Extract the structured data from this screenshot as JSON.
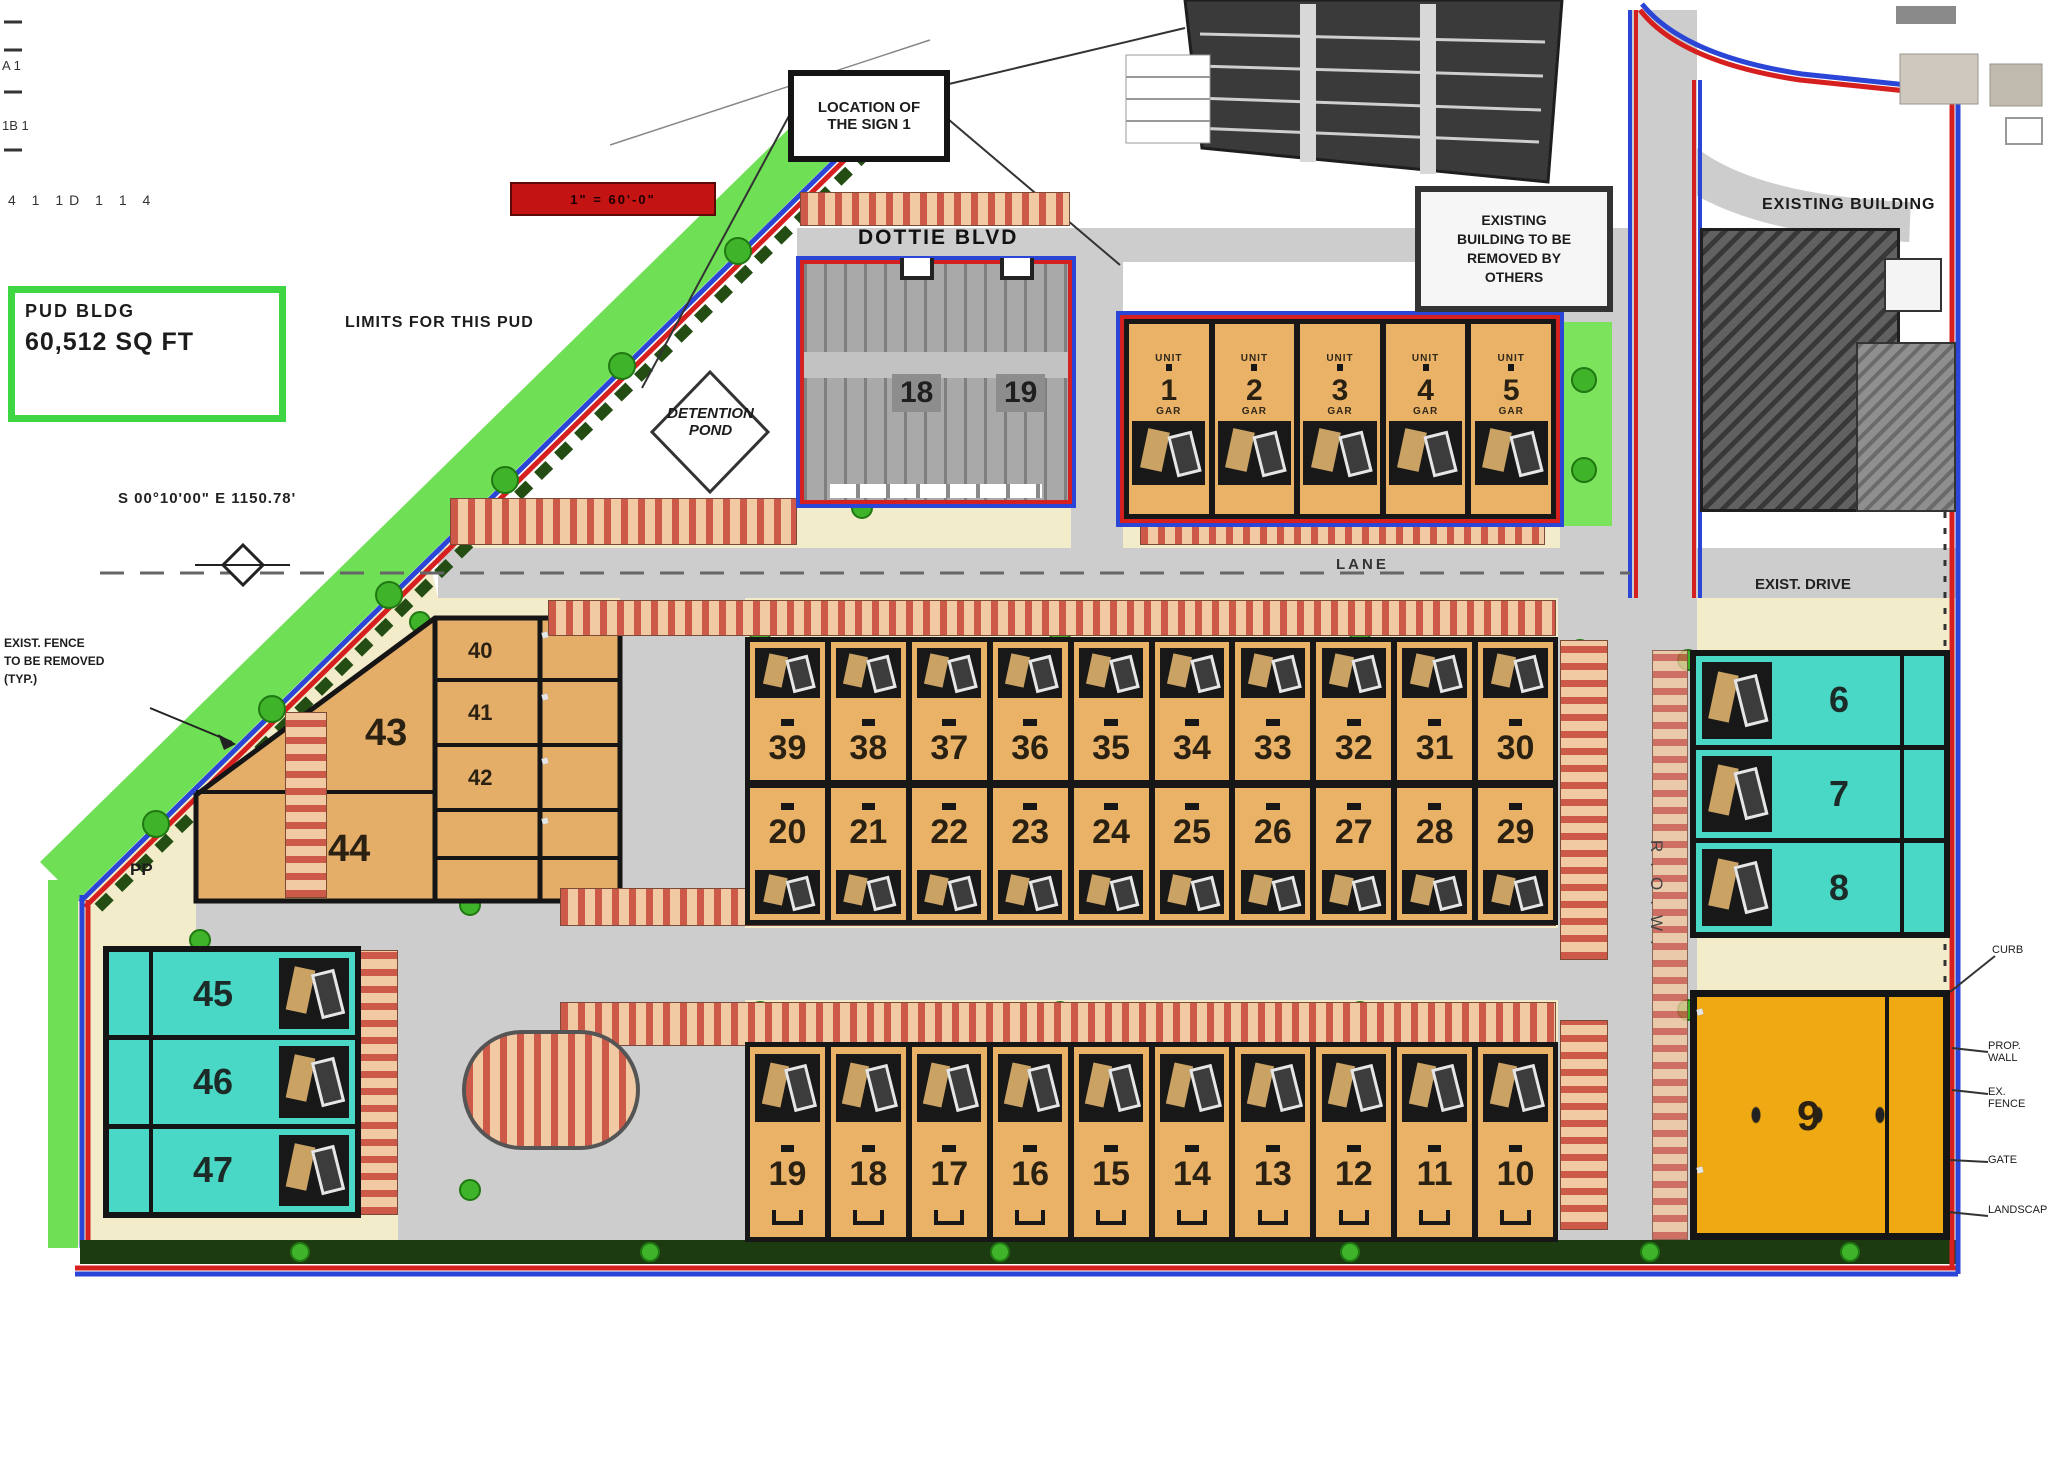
{
  "colors": {
    "boundary_red": "#d61f1f",
    "boundary_blue": "#2b46d6",
    "greenway": "#6fe055",
    "parcel_cream": "#f2ecca",
    "unit_tan": "#e9b267",
    "unit_cyan": "#49d8c5",
    "unit_yellow": "#efa912",
    "road_gray": "#cdcdcd",
    "scalebar_red": "#c31313"
  },
  "labels": {
    "ticks_row": "4    1    1D    1    1    4",
    "corner_a": "A 1",
    "corner_b": "1B 1",
    "scale_text": "1\" = 60'-0\"",
    "mid_note": "LIMITS FOR THIS PUD",
    "bearing": "S 00°10'00\" E   1150.78'",
    "pp": "PP",
    "lane": "LANE",
    "row_vertical": "R.O.W.",
    "exist_drive": "EXIST. DRIVE",
    "existing_building": "EXISTING BUILDING",
    "tag_top": "UNIT",
    "tag_bottom": "GAR"
  },
  "legend_box": {
    "line1": "PUD BLDG",
    "line2": "60,512 SQ FT"
  },
  "sign_box": {
    "line1": "LOCATION OF",
    "line2": "THE SIGN 1"
  },
  "note_box": {
    "lines": [
      "EXISTING",
      "BUILDING TO BE",
      "REMOVED BY",
      "OTHERS"
    ]
  },
  "pond": {
    "line1": "DETENTION",
    "line2": "POND"
  },
  "left_note": {
    "lines": [
      "EXIST. FENCE",
      "TO BE REMOVED",
      "(TYP.)"
    ]
  },
  "streets": {
    "dottie": "DOTTIE BLVD"
  },
  "units": {
    "top_small": [
      "1",
      "2",
      "3",
      "4",
      "5"
    ],
    "gray_building": [
      "18",
      "19"
    ],
    "row_upper": [
      "39",
      "38",
      "37",
      "36",
      "35",
      "34",
      "33",
      "32",
      "31",
      "30"
    ],
    "row_middle": [
      "20",
      "21",
      "22",
      "23",
      "24",
      "25",
      "26",
      "27",
      "28",
      "29"
    ],
    "row_lower": [
      "19",
      "18",
      "17",
      "16",
      "15",
      "14",
      "13",
      "12",
      "11",
      "10"
    ],
    "left_large": [
      "43",
      "44"
    ],
    "left_small": [
      "40",
      "41",
      "42"
    ],
    "cyan_left": [
      "45",
      "46",
      "47"
    ],
    "cyan_right": [
      "6",
      "7",
      "8"
    ],
    "yellow": "9"
  },
  "callouts_right": [
    "CURB",
    "PROP. WALL",
    "EX. FENCE",
    "GATE",
    "LANDSCAPE"
  ]
}
